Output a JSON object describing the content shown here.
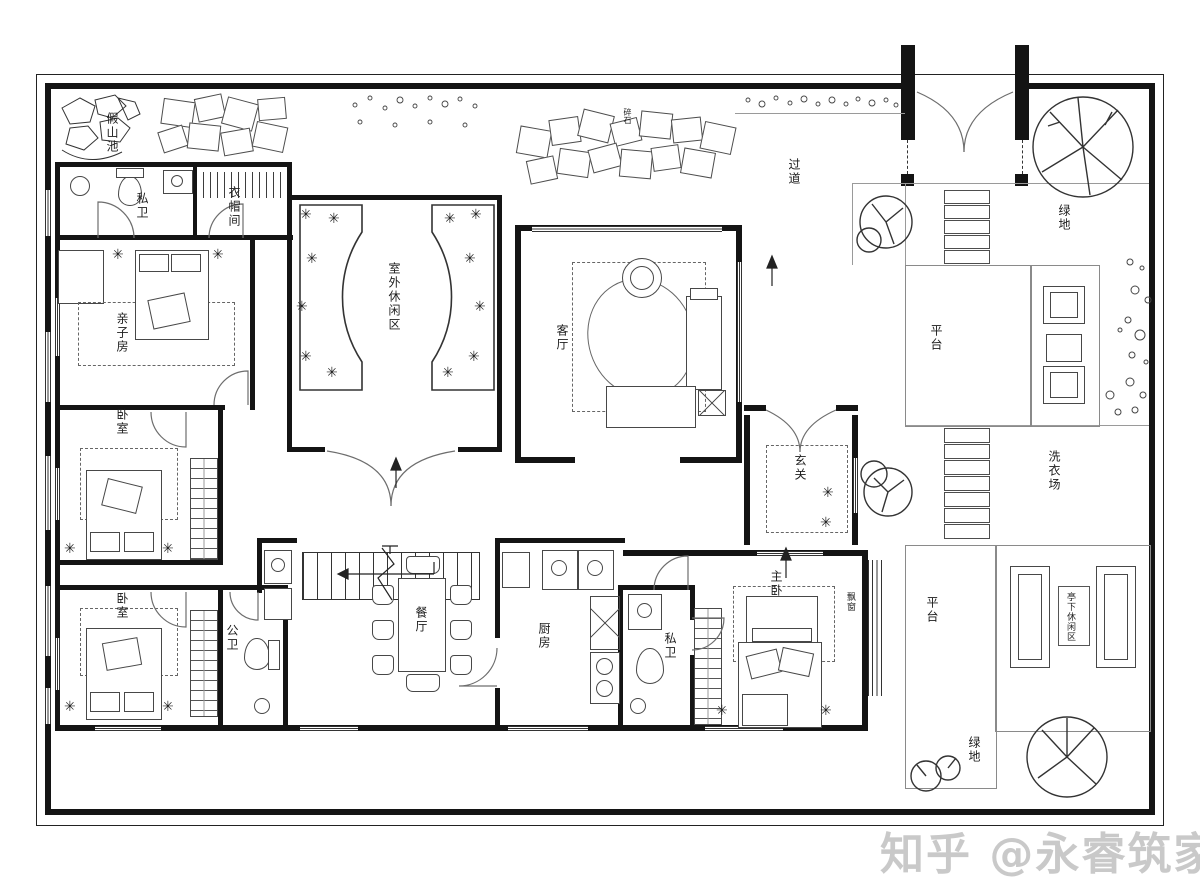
{
  "watermark": "知乎 @永睿筑家",
  "colors": {
    "wall": "#141414",
    "furniture_line": "#474747",
    "zone_line": "#8a8a8a",
    "watermark": "#c9c9c9"
  },
  "rooms": {
    "rockery_pond": "假山池",
    "gravel_paving": "碎石",
    "private_bath_1": "私卫",
    "cloakroom": "衣帽间",
    "family_room": "亲子房",
    "outdoor_lounge": "室外休闲区",
    "living_room": "客厅",
    "passage": "过道",
    "foyer": "玄关",
    "green_top": "绿地",
    "platform_upper": "平台",
    "laundry_yard": "洗衣场",
    "platform_lower": "平台",
    "pavilion_lounge": "亭下休闲区",
    "bedroom_1": "卧室",
    "bedroom_2": "卧室",
    "public_bath": "公卫",
    "dining_room": "餐厅",
    "kitchen": "厨房",
    "private_bath_2": "私卫",
    "master_bedroom": "主卧",
    "bay_window": "飘窗",
    "green_bottom": "绿地"
  }
}
